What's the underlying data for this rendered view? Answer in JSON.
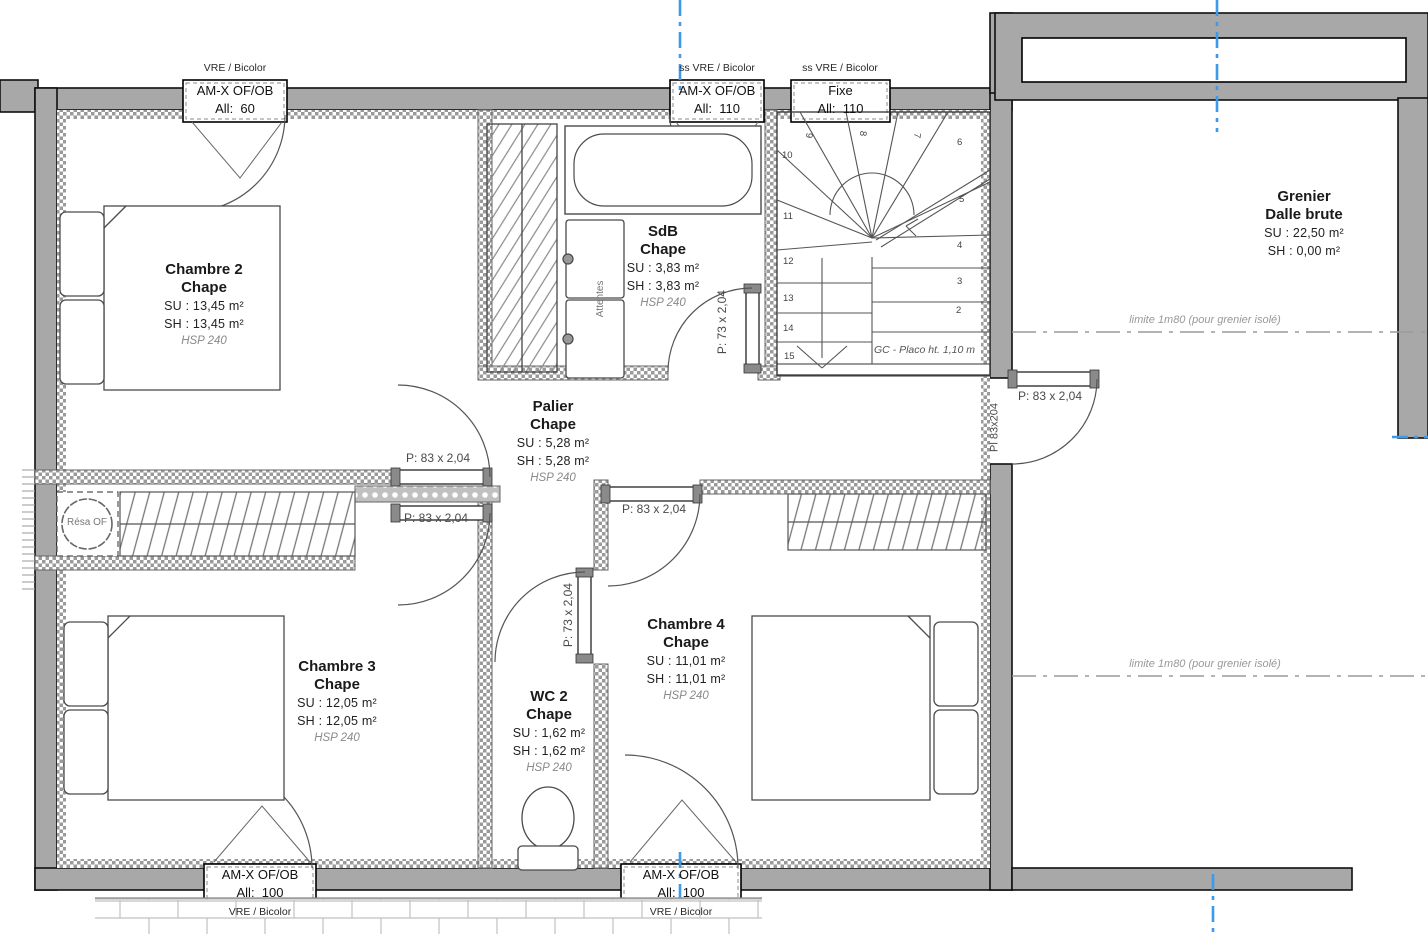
{
  "colors": {
    "wall_gray": "#a8a8a8",
    "blue_axis": "#3d9ae8"
  },
  "rooms": [
    {
      "name": "Chambre 2",
      "finish": "Chape",
      "su": "SU : 13,45 m²",
      "sh": "SH : 13,45 m²",
      "hsp": "HSP 240"
    },
    {
      "name": "SdB",
      "finish": "Chape",
      "su": "SU : 3,83 m²",
      "sh": "SH : 3,83 m²",
      "hsp": "HSP 240"
    },
    {
      "name": "Palier",
      "finish": "Chape",
      "su": "SU : 5,28 m²",
      "sh": "SH : 5,28 m²",
      "hsp": "HSP 240"
    },
    {
      "name": "Chambre 3",
      "finish": "Chape",
      "su": "SU : 12,05 m²",
      "sh": "SH : 12,05 m²",
      "hsp": "HSP 240"
    },
    {
      "name": "WC 2",
      "finish": "Chape",
      "su": "SU : 1,62 m²",
      "sh": "SH : 1,62 m²",
      "hsp": "HSP 240"
    },
    {
      "name": "Chambre 4",
      "finish": "Chape",
      "su": "SU : 11,01 m²",
      "sh": "SH : 11,01 m²",
      "hsp": "HSP 240"
    },
    {
      "name": "Grenier",
      "finish": "Dalle brute",
      "su": "SU : 22,50 m²",
      "sh": "SH : 0,00 m²"
    }
  ],
  "windows": [
    {
      "head": "VRE / Bicolor",
      "type": "AM-X OF/OB",
      "allege": "All:  60"
    },
    {
      "head": "ss VRE / Bicolor",
      "type": "AM-X OF/OB",
      "allege": "All:  110"
    },
    {
      "head": "ss VRE / Bicolor",
      "type": "Fixe",
      "allege": "All:  110"
    },
    {
      "type": "AM-X OF/OB",
      "allege": "All:  100",
      "foot": "VRE / Bicolor"
    },
    {
      "type": "AM-X OF/OB",
      "allege": "All:  100",
      "foot": "VRE / Bicolor"
    }
  ],
  "doors": {
    "chambre2": "P: 83 x 2,04",
    "chambre3": "P: 83 x 2,04",
    "chambre4": "P: 83 x 2,04",
    "grenier": "P: 83 x 2,04",
    "sdb": "P: 73 x 2,04",
    "wc": "P: 73 x 2,04",
    "placard": "Pl 83x204"
  },
  "stairs": {
    "numbers": [
      "2",
      "3",
      "4",
      "5",
      "6",
      "7",
      "8",
      "9",
      "10",
      "11",
      "12",
      "13",
      "14",
      "15"
    ],
    "note": "GC - Placo ht. 1,10 m"
  },
  "annotations": {
    "limite": "limite 1m80 (pour grenier isolé)",
    "resa": "Résa OF",
    "attentes": "Attentes"
  }
}
